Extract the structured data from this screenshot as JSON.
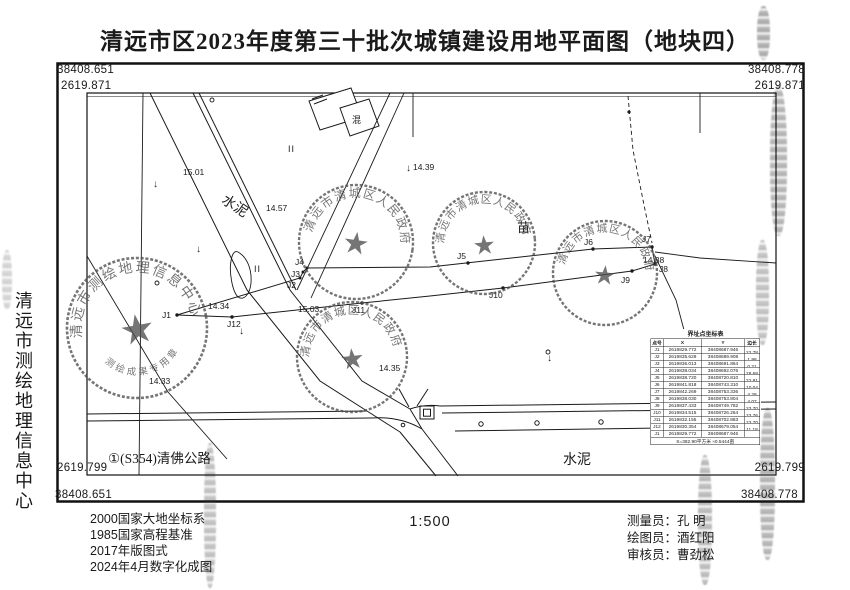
{
  "colors": {
    "ink": "#1a1a1a",
    "seal": "#4f4f4f",
    "paper": "#ffffff"
  },
  "title": "清远市区2023年度第三十批次城镇建设用地平面图（地块四）",
  "frame_coords": {
    "top_left_y": "38408.651",
    "top_left_x": "2619.871",
    "top_right_y": "38408.778",
    "top_right_x": "2619.871",
    "bottom_left_x": "2619.799",
    "bottom_left_y": "38408.651",
    "bottom_right_x": "2619.799",
    "bottom_right_y": "38408.778"
  },
  "side_text": "清远市测绘地理信息中心",
  "map": {
    "labels": {
      "road_s354": "①(S354)清佛公路",
      "cement_bottom": "水泥",
      "cement_diagonal": "水泥",
      "nursery": "苗",
      "building": "混",
      "paddy_1": "II",
      "paddy_2": "II",
      "down_arrow": "↓"
    },
    "elevations": {
      "e1": "15.01",
      "e2": "14.57",
      "e3": "14.39",
      "e4": "14.34",
      "e5": "15.03",
      "e6": "14.33",
      "e7": "14.35",
      "e8": "14.38"
    },
    "points": {
      "j1": "J1",
      "j2": "J2",
      "j3": "J3",
      "j4": "J4",
      "j5": "J5",
      "j6": "J6",
      "j7": "J7",
      "j8": "J8",
      "j9": "J9",
      "j10": "J10",
      "j11": "J11",
      "j12": "J12"
    }
  },
  "seals": {
    "survey_center": {
      "ring": "清远市测绘地理信息中心",
      "banner": "测绘成果专用章",
      "star": "★"
    },
    "gov_a": {
      "ring": "清远市清城区人民政府",
      "star": "★"
    },
    "gov_b": {
      "ring": "清远市清城区人民政府",
      "star": "★"
    },
    "gov_c": {
      "ring": "清远市清城区人民政府",
      "star": "★"
    },
    "gov_d": {
      "ring": "清远市清城区人民政府",
      "star": "★"
    }
  },
  "coord_table": {
    "title": "界址点坐标表",
    "headers": [
      "点号",
      "X",
      "Y",
      "边长"
    ],
    "rows": [
      {
        "pt": "J1",
        "x": "2619829.772",
        "y": "38408687.946",
        "len": "22.78"
      },
      {
        "pt": "J2",
        "x": "2619835.629",
        "y": "38408689.908",
        "len": "1.98"
      },
      {
        "pt": "J3",
        "x": "2619836.013",
        "y": "38408691.864",
        "len": "0.21"
      },
      {
        "pt": "J4",
        "x": "2619838.034",
        "y": "38408692.076",
        "len": "28.68"
      },
      {
        "pt": "J5",
        "x": "2619838.720",
        "y": "38408720.810",
        "len": "22.91"
      },
      {
        "pt": "J6",
        "x": "2619841.818",
        "y": "38408743.310",
        "len": "10.04"
      },
      {
        "pt": "J7",
        "x": "2619842.269",
        "y": "38408753.336",
        "len": "4.28"
      },
      {
        "pt": "J8",
        "x": "2619838.030",
        "y": "38408753.804",
        "len": "4.07"
      },
      {
        "pt": "J9",
        "x": "2619837.433",
        "y": "38408749.782",
        "len": "23.70"
      },
      {
        "pt": "J10",
        "x": "2619834.515",
        "y": "38408726.264",
        "len": "23.76"
      },
      {
        "pt": "J11",
        "x": "2619832.155",
        "y": "38408702.883",
        "len": "23.70"
      },
      {
        "pt": "J12",
        "x": "2619830.354",
        "y": "38408679.054",
        "len": "11.18"
      },
      {
        "pt": "J1",
        "x": "2619829.772",
        "y": "38408687.946",
        "len": ""
      }
    ],
    "summary": "S=382.90平方米  ≈0.5444亩"
  },
  "footer": {
    "notes": [
      "2000国家大地坐标系",
      "1985国家高程基准",
      "2017年版图式",
      "2024年4月数字化成图"
    ],
    "scale": "1:500",
    "staff": [
      {
        "role": "测量员：",
        "name": "孔  明"
      },
      {
        "role": "绘图员：",
        "name": "酒红阳"
      },
      {
        "role": "审核员：",
        "name": "曹劲松"
      }
    ]
  }
}
